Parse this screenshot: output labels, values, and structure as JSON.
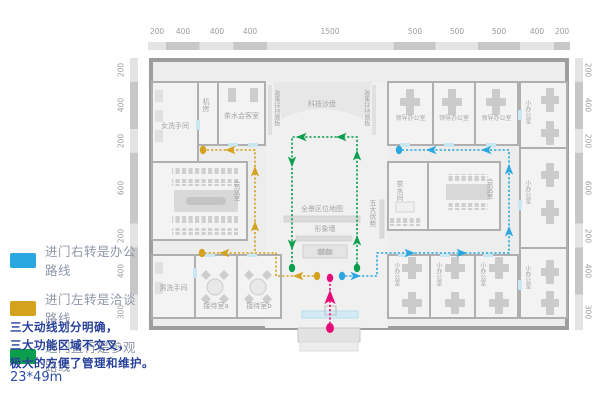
{
  "legend": {
    "items": [
      {
        "key": "office",
        "label": "进门右转是办公路线"
      },
      {
        "key": "talk",
        "label": "进门左转是洽谈路线"
      },
      {
        "key": "visit",
        "label": "进门直行是参观路线"
      }
    ],
    "description_lines": [
      "三大动线划分明确，",
      "三大功能区域不交叉，",
      "极大的方便了管理和维护。"
    ],
    "dimensions_note": "23*49m"
  },
  "colors": {
    "office_route": "#2AA7E0",
    "talk_route": "#D5A21F",
    "visit_route": "#0A9E4D",
    "entrance_route": "#E80C7A",
    "legend_text": "#8E97A8",
    "description_text": "#27409B"
  },
  "dimensions": {
    "top": [
      "200",
      "400",
      "400",
      "400",
      "1500",
      "500",
      "500",
      "500",
      "400",
      "200"
    ],
    "left": [
      "200",
      "400",
      "200",
      "600",
      "200",
      "400",
      "300"
    ],
    "right": [
      "200",
      "400",
      "200",
      "600",
      "200",
      "400",
      "300"
    ]
  },
  "rooms": {
    "women_wc": "女洗手间",
    "machine_room": "机房",
    "tea_reception": "茶水会客室",
    "conference": "会议室",
    "men_wc": "男洗手间",
    "reception_a": "接待室a",
    "reception_b": "接待室b",
    "tech_sandbox": "科技沙盘",
    "policy_board": "政策扶持展板",
    "area_map": "全景区位地图",
    "image_wall": "形象墙",
    "front_desk": "前台",
    "five_advantages": "五大优势",
    "leader_office": "领导办公室",
    "tea_room": "茶水间",
    "small_office": "小办公室"
  }
}
